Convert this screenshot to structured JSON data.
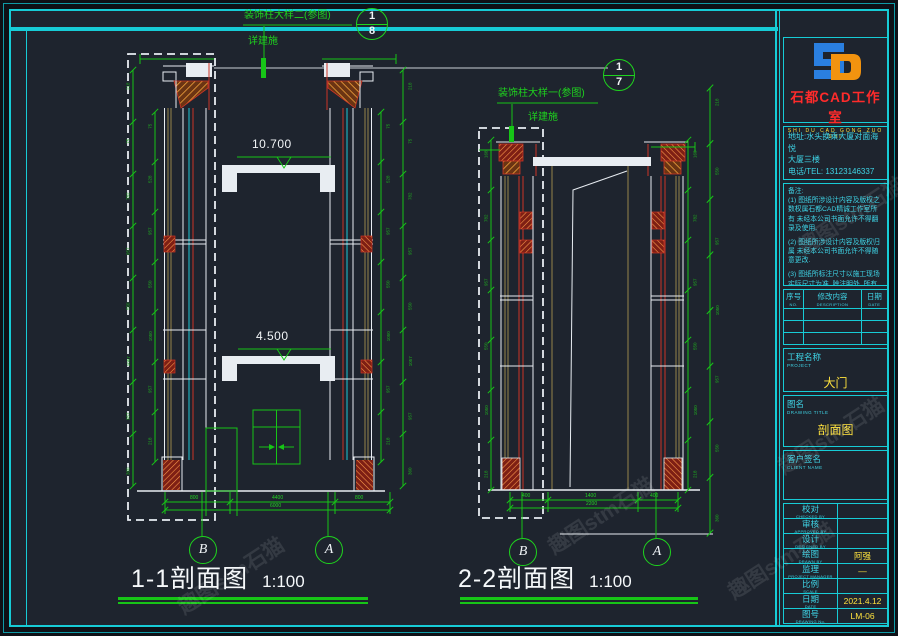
{
  "meta": {
    "background": "#1e242e",
    "frame_cyan": "#17ccd6",
    "dim_green": "#17c517",
    "line_white": "#e8edf2",
    "accent_red": "#cc3526",
    "hatch_orange": "#f2a23c",
    "value_yellow": "#ffe23d",
    "logo_blue": "#2a7fe0",
    "logo_orange": "#f2930f"
  },
  "callouts": {
    "c1": {
      "label": "装饰柱大样二(参图)",
      "sub": "详建施",
      "top": "1",
      "bottom": "8"
    },
    "c2": {
      "label": "装饰柱大样一(参图)",
      "sub": "详建施",
      "top": "1",
      "bottom": "7"
    }
  },
  "section1": {
    "title": "1-1剖面图",
    "scale": "1:100",
    "level_upper": "10.700",
    "level_lower": "4.500",
    "grid_left": "B",
    "grid_right": "A",
    "dims_bottom": [
      "800",
      "4400",
      "800"
    ],
    "dim_total": "6000",
    "ticks_a": [
      "218",
      "75",
      "782",
      "957",
      "550",
      "1057",
      "957",
      "360"
    ],
    "ticks_b": [
      "75",
      "528",
      "957",
      "550",
      "1050",
      "957",
      "218"
    ],
    "ticks_c": [
      "75",
      "528",
      "957",
      "550",
      "1050",
      "957",
      "218"
    ],
    "ticks_d": [
      "218",
      "75",
      "782",
      "957",
      "550",
      "1057",
      "957",
      "360"
    ]
  },
  "section2": {
    "title": "2-2剖面图",
    "scale": "1:100",
    "grid_left": "B",
    "grid_right": "A",
    "dims_bottom": [
      "400",
      "1400",
      "400"
    ],
    "dim_total": "2200",
    "ticks_e": [
      "168",
      "782",
      "957",
      "550",
      "1050",
      "218"
    ],
    "ticks_f": [
      "168",
      "782",
      "957",
      "550",
      "1050",
      "218"
    ],
    "ticks_g": [
      "218",
      "550",
      "957",
      "1050",
      "957",
      "550",
      "360"
    ]
  },
  "titleblock": {
    "studio_name": "石都CAD工作室",
    "studio_sub": "SHI DU CAD GONG ZUO SHI",
    "address_line1": "地址:水头换乘大厦对面海悦",
    "address_line2": "大厦三楼",
    "phone": "电话/TEL: 13123146337",
    "notes_title": "备注:",
    "notes": [
      "(1) 图纸所涉设计内容及版权之数权属石都CAD精诚工作室所有 未经本公司书面允许不得翻录及使用.",
      "(2) 图纸所涉设计内容及版权归属 未经本公司书面允许不得随意更改.",
      "(3) 图纸所标注尺寸以施工现场实际尺寸为准, 除注明外, 所有尺寸均以毫米单位."
    ],
    "rev_headers": [
      {
        "zh": "序号",
        "en": "NO."
      },
      {
        "zh": "修改内容",
        "en": "DESCRIPTION"
      },
      {
        "zh": "日期",
        "en": "DATE"
      }
    ],
    "project_label_zh": "工程名称",
    "project_label_en": "PROJECT",
    "project_value": "大门",
    "drawing_label_zh": "图名",
    "drawing_label_en": "DRAWING TITLE",
    "drawing_value": "剖面图",
    "client_label_zh": "客户签名",
    "client_label_en": "CLIENT NAME",
    "sign_rows": [
      {
        "zh": "校对",
        "en": "CHECKED BY",
        "value": ""
      },
      {
        "zh": "审核",
        "en": "APPROVED BY",
        "value": ""
      },
      {
        "zh": "设计",
        "en": "DESIGNED BY",
        "value": ""
      },
      {
        "zh": "绘图",
        "en": "DRAWN BY",
        "value": "阿强"
      },
      {
        "zh": "监理",
        "en": "PROJECT MANAGER",
        "value": "—"
      },
      {
        "zh": "比例",
        "en": "SCALE",
        "value": ""
      },
      {
        "zh": "日期",
        "en": "DATE",
        "value": "2021.4.12"
      },
      {
        "zh": "图号",
        "en": "DRAWING No.",
        "value": "LM-06"
      }
    ]
  },
  "watermark": "趣图stm石猫"
}
